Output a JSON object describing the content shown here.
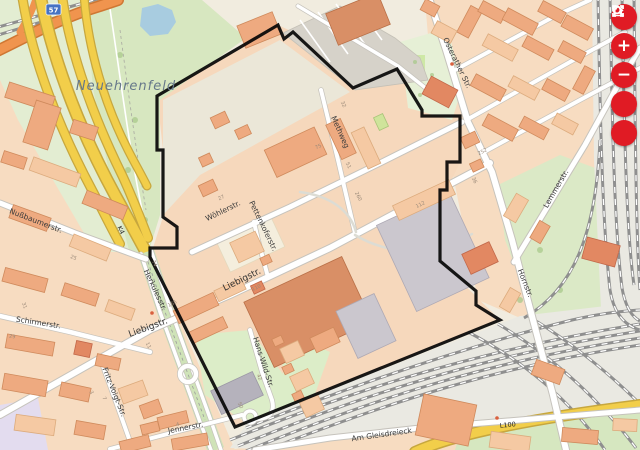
{
  "place_labels": {
    "neighbourhood": "Neuehrenfeld"
  },
  "street_labels": {
    "wohlerstr": "Wöhlerstr.",
    "pettenkoferstr": "Pettenkoferstr.",
    "liebigstr_main": "Liebigstr.",
    "liebigstr_west": "Liebigstr.",
    "methweg": "Methweg",
    "osterather": "Osterather Str.",
    "lemmerstr": "Lemmerstr.",
    "hornstr": "Hornstr.",
    "herkulesstr": "Herkulesstr.",
    "nussbaumerstr": "Nußbaumerstr.",
    "schirmerstr": "Schirmerstr.",
    "fritz_voigt": "Fritz-Voigt-Str.",
    "jennerstr": "Jennerstr.",
    "hans_wild": "Hans-Wild-Str.",
    "am_gleisdreieck": "Am Gleisdreieck"
  },
  "road_refs": {
    "k4": "K4",
    "l100": "L100",
    "motorway_shield": "57"
  },
  "house_numbers": [
    "27",
    "112",
    "165",
    "74",
    "260",
    "50",
    "42",
    "36",
    "252",
    "32",
    "75",
    "51",
    "25",
    "31",
    "3",
    "7",
    "11",
    "4",
    "110",
    "29"
  ],
  "controls": {
    "buttons": [
      {
        "name": "fullscreen",
        "label": ""
      },
      {
        "name": "zoom-in",
        "label": "+"
      },
      {
        "name": "zoom-out",
        "label": "−"
      },
      {
        "name": "search",
        "label": ""
      },
      {
        "name": "home",
        "label": ""
      }
    ]
  },
  "colors": {
    "control_red": "#e01b24",
    "boundary": "#000000",
    "road_yellow": "#f2ce4a",
    "water": "#a8cce0",
    "park_green": "#d7e7c0"
  }
}
